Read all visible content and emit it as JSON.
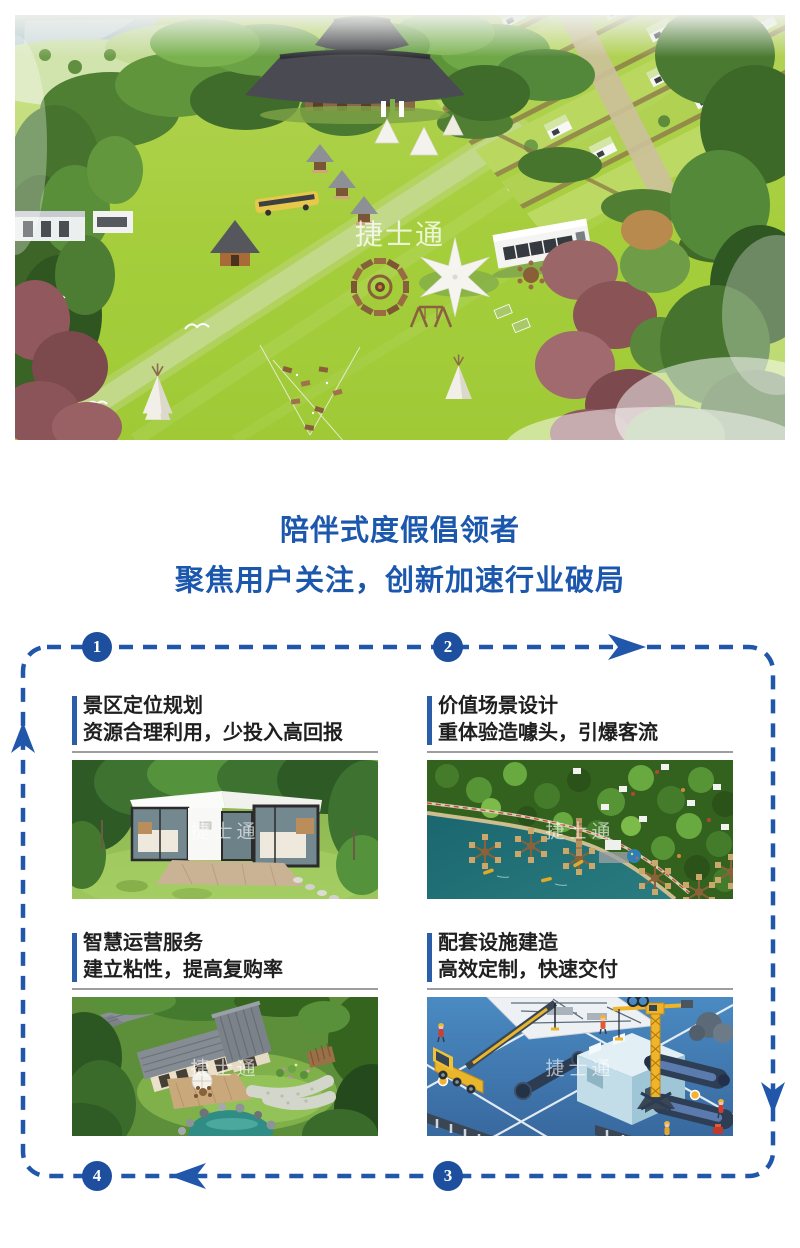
{
  "hero": {
    "watermark": "捷士通"
  },
  "intro": {
    "line1": "陪伴式度假倡领者",
    "line2": "聚焦用户关注，创新加速行业破局"
  },
  "flow": {
    "steps": [
      "1",
      "2",
      "3",
      "4"
    ],
    "cards": [
      {
        "title": "景区定位规划",
        "subtitle": "资源合理利用，少投入高回报",
        "watermark": "捷士通"
      },
      {
        "title": "价值场景设计",
        "subtitle": "重体验造噱头，引爆客流",
        "watermark": "捷士通"
      },
      {
        "title": "智慧运营服务",
        "subtitle": "建立粘性，提高复购率",
        "watermark": "捷士通"
      },
      {
        "title": "配套设施建造",
        "subtitle": "高效定制，快速交付",
        "watermark": "捷士通"
      }
    ]
  },
  "colors": {
    "accent_blue": "#1b57ad",
    "flow_dash_blue": "#2157ab",
    "step_circle_blue": "#1e4f9e",
    "heading_text": "#1f1f1f",
    "rule_gray": "#9e9e9e"
  }
}
